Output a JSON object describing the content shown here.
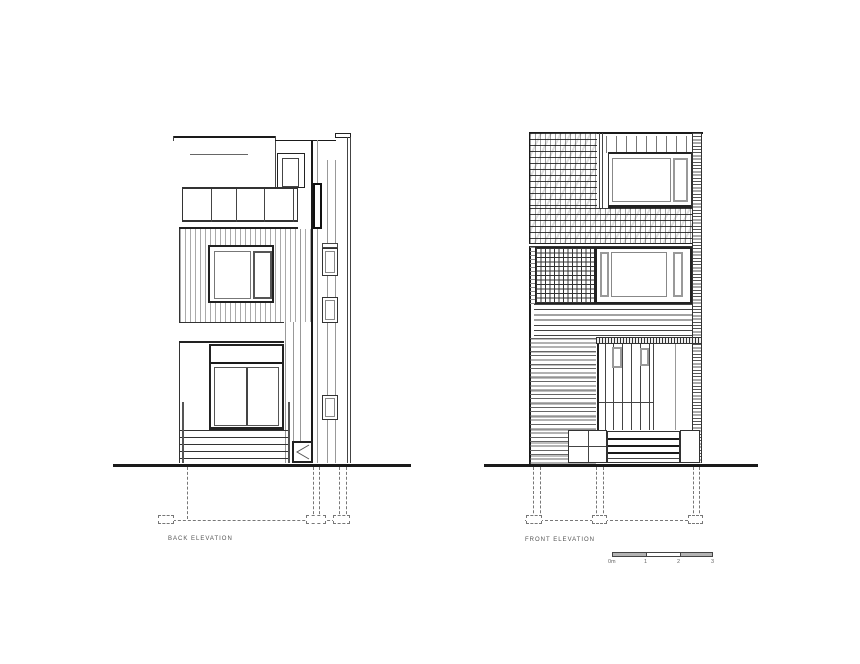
{
  "page": {
    "background": "#ffffff"
  },
  "back_elevation": {
    "title": "BACK ELEVATION"
  },
  "front_elevation": {
    "title": "FRONT ELEVATION"
  },
  "scale_bar": {
    "unit_labels": [
      "0m",
      "1",
      "2",
      "3"
    ],
    "segment_fill": "#b3b3b3"
  },
  "colors": {
    "ink": "#1a1a1a",
    "light_line": "#777777"
  }
}
